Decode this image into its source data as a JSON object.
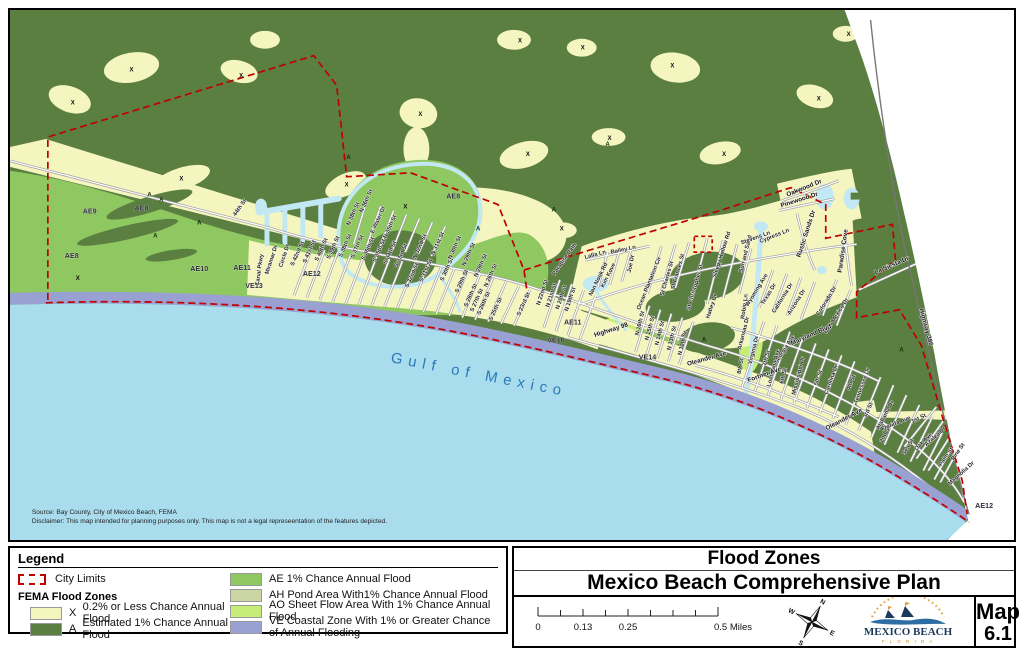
{
  "colors": {
    "zone_x": "#f5f5c0",
    "zone_a": "#5a7f40",
    "zone_ae": "#8fc761",
    "zone_ah": "#ccd6a4",
    "zone_ao": "#c7ec78",
    "zone_ve": "#98a1d1",
    "water": "#a9dced",
    "canal": "#c2e8f3",
    "city_limits": "#c00000",
    "road": "#8a8a8a"
  },
  "map": {
    "source": "Source: Bay County, City of Mexico Beach, FEMA",
    "disclaimer": "Disclaimer: This map intended for planning purposes only. This map is not a legal represeentation of the features depicted.",
    "water_label": "Gulf of Mexico",
    "zone_labels": [
      {
        "t": "AE9",
        "x": 80,
        "y": 205
      },
      {
        "t": "AE8",
        "x": 132,
        "y": 202
      },
      {
        "t": "AE8",
        "x": 62,
        "y": 250
      },
      {
        "t": "AE10",
        "x": 190,
        "y": 263
      },
      {
        "t": "AE11",
        "x": 233,
        "y": 262
      },
      {
        "t": "VE13",
        "x": 245,
        "y": 280
      },
      {
        "t": "AE12",
        "x": 303,
        "y": 268
      },
      {
        "t": "AE8",
        "x": 445,
        "y": 190
      },
      {
        "t": "AE11",
        "x": 565,
        "y": 317
      },
      {
        "t": "VE16",
        "x": 548,
        "y": 335
      },
      {
        "t": "VE14",
        "x": 640,
        "y": 352
      },
      {
        "t": "AE12",
        "x": 978,
        "y": 502
      }
    ],
    "x_marks": [
      {
        "x": 63,
        "y": 95
      },
      {
        "x": 122,
        "y": 62
      },
      {
        "x": 232,
        "y": 68
      },
      {
        "x": 172,
        "y": 172
      },
      {
        "x": 338,
        "y": 178
      },
      {
        "x": 412,
        "y": 107
      },
      {
        "x": 512,
        "y": 33
      },
      {
        "x": 575,
        "y": 40
      },
      {
        "x": 520,
        "y": 147
      },
      {
        "x": 602,
        "y": 131
      },
      {
        "x": 717,
        "y": 147
      },
      {
        "x": 812,
        "y": 91
      },
      {
        "x": 842,
        "y": 26
      },
      {
        "x": 68,
        "y": 272
      },
      {
        "x": 554,
        "y": 222
      },
      {
        "x": 397,
        "y": 200
      },
      {
        "x": 665,
        "y": 58
      }
    ],
    "a_marks": [
      {
        "x": 140,
        "y": 188
      },
      {
        "x": 152,
        "y": 193
      },
      {
        "x": 146,
        "y": 229
      },
      {
        "x": 190,
        "y": 216
      },
      {
        "x": 600,
        "y": 137
      },
      {
        "x": 470,
        "y": 222
      },
      {
        "x": 546,
        "y": 203
      },
      {
        "x": 697,
        "y": 334
      },
      {
        "x": 895,
        "y": 344
      },
      {
        "x": 340,
        "y": 150
      }
    ],
    "street_labels": [
      {
        "t": "44th St",
        "x": 232,
        "y": 200,
        "r": -55
      },
      {
        "t": "Canal Pkwy",
        "x": 252,
        "y": 262,
        "r": -82
      },
      {
        "t": "Miramar Dr",
        "x": 264,
        "y": 252,
        "r": -72
      },
      {
        "t": "Circle Dr",
        "x": 277,
        "y": 248,
        "r": -72
      },
      {
        "t": "S 42nd St",
        "x": 290,
        "y": 246,
        "r": -66
      },
      {
        "t": "S 41st St",
        "x": 302,
        "y": 244,
        "r": -66
      },
      {
        "t": "S 40th St",
        "x": 314,
        "y": 242,
        "r": -66
      },
      {
        "t": "S 39th St",
        "x": 326,
        "y": 240,
        "r": -66
      },
      {
        "t": "S 38th St",
        "x": 338,
        "y": 238,
        "r": -66
      },
      {
        "t": "N 38th St",
        "x": 346,
        "y": 206,
        "r": -66
      },
      {
        "t": "S 37th St",
        "x": 350,
        "y": 239,
        "r": -66
      },
      {
        "t": "N 36th St",
        "x": 359,
        "y": 193,
        "r": -66
      },
      {
        "t": "S 36th St",
        "x": 361,
        "y": 241,
        "r": -66
      },
      {
        "t": "E Water Dr",
        "x": 371,
        "y": 212,
        "r": -66
      },
      {
        "t": "S 35th St",
        "x": 372,
        "y": 243,
        "r": -66
      },
      {
        "t": "N 35th St",
        "x": 383,
        "y": 219,
        "r": -66
      },
      {
        "t": "S 34th St",
        "x": 383,
        "y": 245,
        "r": -66
      },
      {
        "t": "S 33rd St",
        "x": 394,
        "y": 248,
        "r": -66
      },
      {
        "t": "S 32nd St",
        "x": 405,
        "y": 268,
        "r": -66
      },
      {
        "t": "N 32nd St",
        "x": 413,
        "y": 239,
        "r": -66
      },
      {
        "t": "S 31st St",
        "x": 419,
        "y": 263,
        "r": -66
      },
      {
        "t": "N 31st St",
        "x": 431,
        "y": 236,
        "r": -66
      },
      {
        "t": "S 30th St",
        "x": 440,
        "y": 262,
        "r": -66
      },
      {
        "t": "N 30th St",
        "x": 448,
        "y": 240,
        "r": -66
      },
      {
        "t": "S 29th St",
        "x": 455,
        "y": 274,
        "r": -66
      },
      {
        "t": "N 29th St",
        "x": 462,
        "y": 247,
        "r": -66
      },
      {
        "t": "S 28th St",
        "x": 464,
        "y": 288,
        "r": -66
      },
      {
        "t": "N 28th St",
        "x": 474,
        "y": 258,
        "r": -66
      },
      {
        "t": "S 27th St",
        "x": 470,
        "y": 293,
        "r": -66
      },
      {
        "t": "S 26th St",
        "x": 477,
        "y": 296,
        "r": -66
      },
      {
        "t": "N 26th St",
        "x": 484,
        "y": 268,
        "r": -66
      },
      {
        "t": "S 25th St",
        "x": 489,
        "y": 302,
        "r": -66
      },
      {
        "t": "S 23rd St",
        "x": 517,
        "y": 297,
        "r": -66
      },
      {
        "t": "N 22nd St",
        "x": 536,
        "y": 285,
        "r": -72
      },
      {
        "t": "N 21st St",
        "x": 545,
        "y": 288,
        "r": -72
      },
      {
        "t": "N 20th St",
        "x": 555,
        "y": 290,
        "r": -72
      },
      {
        "t": "N 19th St",
        "x": 564,
        "y": 292,
        "r": -72
      },
      {
        "t": "Paradise Path",
        "x": 558,
        "y": 252,
        "r": -55
      },
      {
        "t": "Lalla Ln",
        "x": 588,
        "y": 248,
        "r": -15
      },
      {
        "t": "Bailey Ln",
        "x": 616,
        "y": 243,
        "r": -12
      },
      {
        "t": "Nan Nook Rd",
        "x": 592,
        "y": 272,
        "r": -64
      },
      {
        "t": "Kim Kove",
        "x": 602,
        "y": 268,
        "r": -64
      },
      {
        "t": "Joe Dr",
        "x": 625,
        "y": 256,
        "r": -78
      },
      {
        "t": "Ocean Plantation Cir",
        "x": 643,
        "y": 276,
        "r": -68
      },
      {
        "t": "St Charles St",
        "x": 661,
        "y": 271,
        "r": -74
      },
      {
        "t": "St Frances St",
        "x": 672,
        "y": 264,
        "r": -74
      },
      {
        "t": "St Christopher St",
        "x": 689,
        "y": 280,
        "r": -74
      },
      {
        "t": "Sleepy Hollow Rd",
        "x": 716,
        "y": 247,
        "r": -72
      },
      {
        "t": "Sun and Sand",
        "x": 740,
        "y": 246,
        "r": -76
      },
      {
        "t": "Stevens Ln",
        "x": 749,
        "y": 231,
        "r": -20
      },
      {
        "t": "Cypress Ln",
        "x": 768,
        "y": 229,
        "r": -22
      },
      {
        "t": "Hatley Dr",
        "x": 706,
        "y": 299,
        "r": -72
      },
      {
        "t": "Robin Ln",
        "x": 739,
        "y": 299,
        "r": -82
      },
      {
        "t": "N 16th St",
        "x": 634,
        "y": 316,
        "r": -76
      },
      {
        "t": "N 15th St",
        "x": 644,
        "y": 321,
        "r": -76
      },
      {
        "t": "N 14th St",
        "x": 654,
        "y": 326,
        "r": -76
      },
      {
        "t": "N 13th St",
        "x": 666,
        "y": 331,
        "r": -76
      },
      {
        "t": "N 12th St",
        "x": 677,
        "y": 336,
        "r": -76
      },
      {
        "t": "Wyoming Ave",
        "x": 751,
        "y": 283,
        "r": -58
      },
      {
        "t": "Texas Dr",
        "x": 763,
        "y": 287,
        "r": -58
      },
      {
        "t": "California Dr",
        "x": 777,
        "y": 291,
        "r": -58
      },
      {
        "t": "Arizona Dr",
        "x": 791,
        "y": 295,
        "r": -58
      },
      {
        "t": "Colorado Dr",
        "x": 821,
        "y": 294,
        "r": -58
      },
      {
        "t": "New Mexico Dr",
        "x": 831,
        "y": 309,
        "r": -58
      },
      {
        "t": "Arkansas Dr",
        "x": 738,
        "y": 326,
        "r": -76
      },
      {
        "t": "Virginia Dr",
        "x": 748,
        "y": 343,
        "r": -76
      },
      {
        "t": "8th St",
        "x": 735,
        "y": 359,
        "r": -80
      },
      {
        "t": "7th St",
        "x": 761,
        "y": 351,
        "r": -76
      },
      {
        "t": "Georgia Ave",
        "x": 779,
        "y": 343,
        "r": -58
      },
      {
        "t": "Louisiana Ave",
        "x": 768,
        "y": 361,
        "r": -76
      },
      {
        "t": "6th St",
        "x": 778,
        "y": 369,
        "r": -76
      },
      {
        "t": "Mississippi Dr",
        "x": 793,
        "y": 369,
        "r": -76
      },
      {
        "t": "5th St",
        "x": 813,
        "y": 371,
        "r": -72
      },
      {
        "t": "Carolina Dr",
        "x": 826,
        "y": 373,
        "r": -70
      },
      {
        "t": "4th St",
        "x": 846,
        "y": 376,
        "r": -70
      },
      {
        "t": "Tennessee Dr",
        "x": 857,
        "y": 379,
        "r": -70
      },
      {
        "t": "3rd St",
        "x": 863,
        "y": 404,
        "r": -66
      },
      {
        "t": "Alabama Dr",
        "x": 880,
        "y": 409,
        "r": -62
      },
      {
        "t": "2nd St",
        "x": 880,
        "y": 428,
        "r": -64
      },
      {
        "t": "Florida Ave",
        "x": 890,
        "y": 418,
        "r": -22
      },
      {
        "t": "1st St",
        "x": 913,
        "y": 413,
        "r": -25
      },
      {
        "t": "Sea St",
        "x": 903,
        "y": 441,
        "r": -60
      },
      {
        "t": "Oak Ave",
        "x": 918,
        "y": 436,
        "r": -45
      },
      {
        "t": "Azalea Dr",
        "x": 930,
        "y": 431,
        "r": -42
      },
      {
        "t": "Palm St",
        "x": 941,
        "y": 451,
        "r": -55
      },
      {
        "t": "Pine St",
        "x": 953,
        "y": 446,
        "r": -55
      },
      {
        "t": "Magnolia Dr",
        "x": 956,
        "y": 468,
        "r": -42
      }
    ],
    "road_labels": [
      {
        "t": "Highway 98",
        "x": 604,
        "y": 324,
        "r": -18
      },
      {
        "t": "Oleander Ave",
        "x": 700,
        "y": 353,
        "r": -16
      },
      {
        "t": "Oleander Ave",
        "x": 838,
        "y": 414,
        "r": -28
      },
      {
        "t": "Fortner Ave",
        "x": 758,
        "y": 369,
        "r": -20
      },
      {
        "t": "Maryland Blvd",
        "x": 805,
        "y": 329,
        "r": -24
      },
      {
        "t": "La Siesta Dr",
        "x": 886,
        "y": 259,
        "r": -24
      },
      {
        "t": "Highway 386",
        "x": 918,
        "y": 320,
        "r": 75
      },
      {
        "t": "Oakwood Dr",
        "x": 798,
        "y": 181,
        "r": -22
      },
      {
        "t": "Pinewood Dr",
        "x": 793,
        "y": 193,
        "r": -18
      },
      {
        "t": "Rustic Sands Dr",
        "x": 801,
        "y": 226,
        "r": -72
      },
      {
        "t": "Paradise Cove",
        "x": 838,
        "y": 243,
        "r": -82
      }
    ]
  },
  "legend": {
    "title": "Legend",
    "city_limits": "City Limits",
    "fema_title": "FEMA Flood Zones",
    "items_left": [
      {
        "code": "X",
        "label": "0.2% or Less Chance Annual Flood"
      },
      {
        "code": "A",
        "label": "Estimated 1% Chance Annual Flood"
      }
    ],
    "items_right": [
      {
        "code": "AE",
        "label": "AE 1% Chance Annual Flood"
      },
      {
        "code": "AH",
        "label": "AH Pond Area With1% Chance Annual Flood"
      },
      {
        "code": "AO",
        "label": "AO Sheet Flow Area With 1% Chance Annual Flood"
      },
      {
        "code": "VE",
        "label": "VE  Coastal Zone With 1% or Greater Chance of Annual Flooding"
      }
    ]
  },
  "title_block": {
    "title1": "Flood Zones",
    "title2": "Mexico Beach Comprehensive Plan",
    "scale": {
      "t0": "0",
      "t1": "0.13",
      "t2": "0.25",
      "t3": "0.5 Miles"
    },
    "compass": {
      "n": "N",
      "e": "E",
      "s": "S",
      "w": "W"
    },
    "logo": {
      "name": "MEXICO BEACH",
      "sub": "F L O R I D A"
    },
    "map_label": "Map",
    "map_number": "6.1"
  }
}
